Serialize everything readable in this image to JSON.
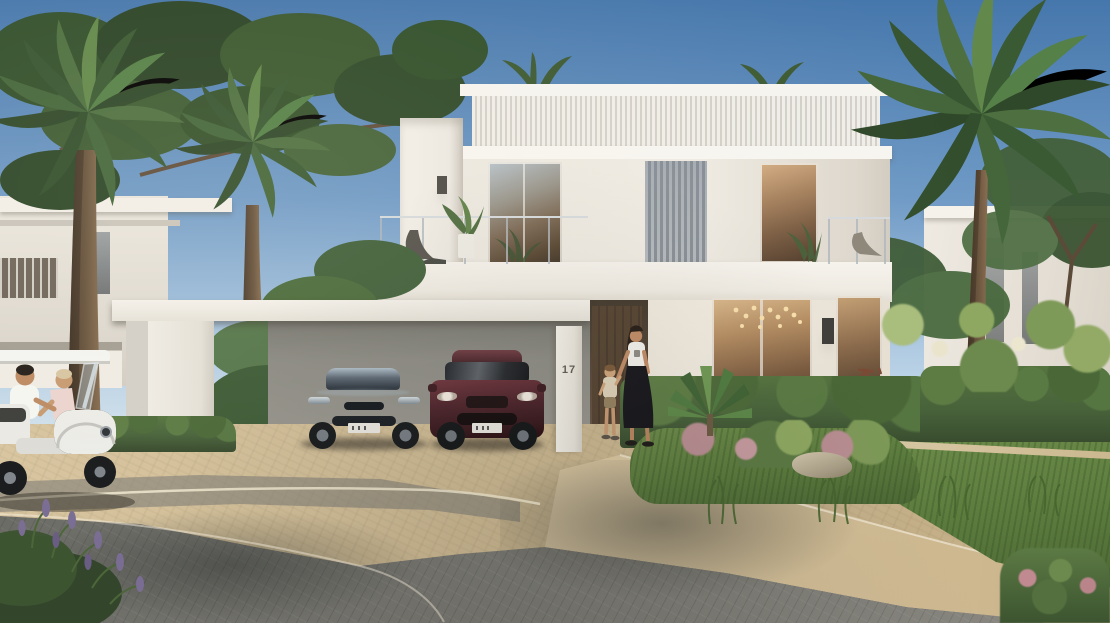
{
  "scene": {
    "type": "photorealistic exterior rendering",
    "description": "Street view of a modern two-storey white villa on a sunny day: slatted facade screens, glass-railed roof terrace, carport with a dark sedan and a maroon SUV, mother and child walking to the entrance, residents on a white golf buggy in the foreground, tall palms, a pine tree, hedges and flowering gardens along a curved paver driveway.",
    "sky": "clear blue, brighter toward horizon",
    "lighting": "warm afternoon sun from the left"
  },
  "villa": {
    "house_number": "17",
    "storeys": "2",
    "features": [
      "slatted roof parapet",
      "central vertical louvre screen",
      "floor-to-ceiling glazing",
      "roof terrace with lounge chair and potted plant",
      "small right balcony with chair",
      "carport portal frame",
      "warm interior lights and chandelier in ground-floor window",
      "wall sconces",
      "dark timber entrance door"
    ]
  },
  "objects": {
    "car_sedan": "dark blue-grey electric sedan, white license plate",
    "car_suv": "dark maroon SUV, white license plate",
    "golf_buggy": "white golf buggy with male driver in white t-shirt and companion in pale pink shirt leaning beside",
    "woman": "woman with long dark hair, white t-shirt, long black skirt, holding child's hand",
    "child": "toddler in beige shirt and khaki shorts",
    "bicycle": "bicycle leaning on wall behind hedge",
    "palm_trees": "three tall date palms plus small crowns behind the roof",
    "pine_tree": "umbrella pine canopy, top left",
    "neighbour_villas": "white villas left and right in background",
    "garden": "hedgerows, plumeria bushes with cream blossoms, ornamental grasses, pink flowering shrubs, rock, lavender in foreground corner",
    "road": "grey paver road in shade with tree shadows, sunlit beige paver driveway and sweeping sidewalk band"
  },
  "colors": {
    "sky_top": "#4677ac",
    "sky_horizon": "#cfe0ec",
    "wall_sunlit": "#f3f0e9",
    "wall_shaded": "#d8d4cc",
    "louvre_grey": "#9aa1a8",
    "glass_warm": "#6e5640",
    "hedge_green": "#47613a",
    "lawn_green": "#5c7c3e",
    "palm_green": "#4e7040",
    "trunk_brown": "#5e4a38",
    "driveway_beige": "#d8c5a0",
    "road_grey": "#76756f",
    "sedan_color": "#2e3845",
    "suv_color": "#45222a",
    "buggy_white": "#efefec"
  }
}
